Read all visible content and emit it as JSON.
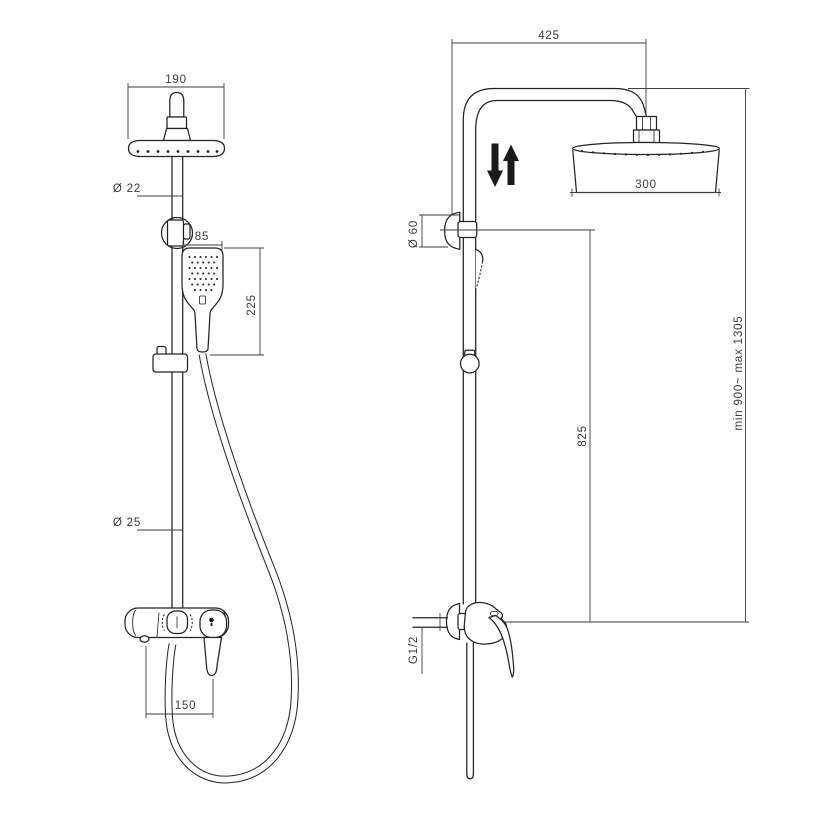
{
  "drawing_title": "shower-column-technical-drawing",
  "colors": {
    "background": "#ffffff",
    "object_line": "#232323",
    "dimension_line": "#3e3e3e",
    "text": "#3a3a3a",
    "arrow": "#1a1a1a"
  },
  "icons": {
    "height_adjust_arrows": "up-down-arrows"
  },
  "views": {
    "front": {
      "name": "front-view",
      "dimensions": {
        "head_width": "190",
        "upper_pipe_diameter": "Ø 22",
        "handshower_width": "85",
        "handshower_length": "225",
        "lower_pipe_diameter": "Ø 25",
        "mixer_ports_distance": "150"
      }
    },
    "side": {
      "name": "side-view",
      "dimensions": {
        "arm_reach": "425",
        "head_diameter": "300",
        "wall_bracket_diameter": "Ø 60",
        "rail_height": "825",
        "column_height_range": "min 900~ max 1305",
        "inlet_connection": "G1/2"
      }
    }
  }
}
